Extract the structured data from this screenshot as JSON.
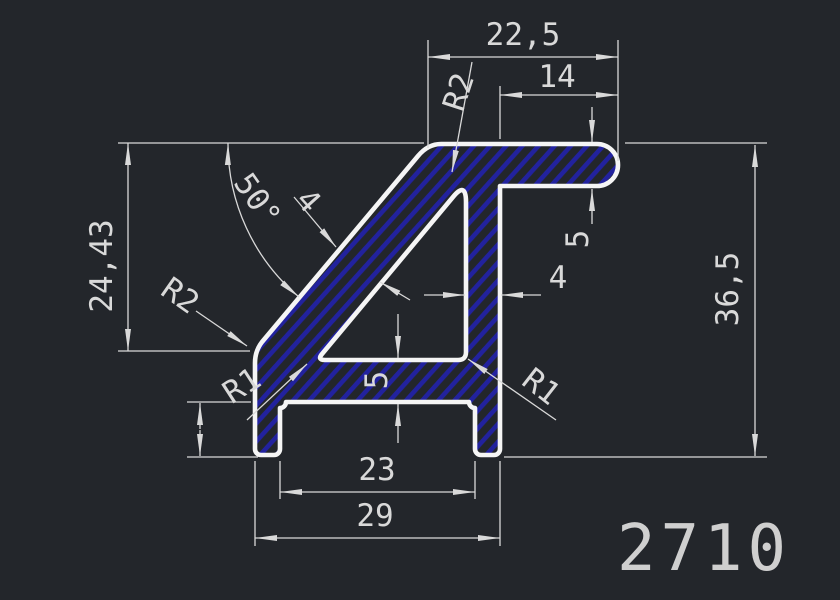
{
  "drawing": {
    "part_number": "2710",
    "dimensions": {
      "top_width": "22,5",
      "arm_length": "14",
      "arm_thickness": "5",
      "left_height": "24,43",
      "overall_height": "36,5",
      "angle": "50°",
      "diagonal_thickness": "4",
      "web_thickness": "4",
      "base_thickness": "5",
      "foot_height": "6,5",
      "inner_width": "23",
      "outer_width": "29",
      "radius_top": "R2",
      "radius_left_corner": "R2",
      "radius_inner_left": "R1",
      "radius_inner_right": "R1"
    },
    "colors": {
      "background": "#23262b",
      "outline": "#f5f5f5",
      "dimension": "#d9d9d9",
      "hatch": "#22229e"
    }
  }
}
